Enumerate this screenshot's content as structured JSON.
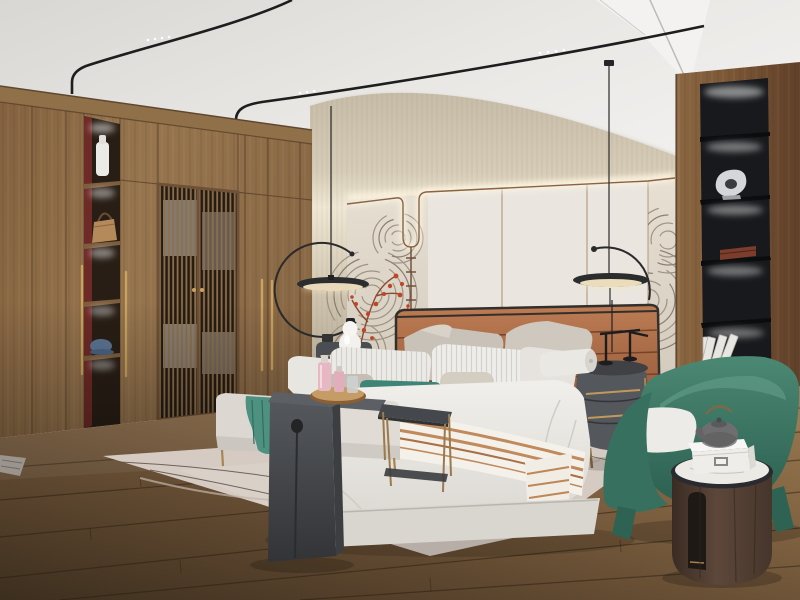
{
  "scene": {
    "type": "3d-interior-render",
    "room": "modern new-chinese style bedroom",
    "description": "Photorealistic render of a bedroom: walnut wardrobe with lit niches and lattice doors on the left, backlit mural feature wall and upholstered bed in the center, black display shelving in a wood wall on the right, green barrel armchair with drum side table, pale rug with pinecones on walnut plank flooring, disc pendant lamps and black ceiling light tracks",
    "lighting": "warm cove LED strips, niche spots and disc pendants",
    "camera": "three-quarter room view"
  },
  "palette": {
    "ceiling": "#e9e7e4",
    "cove_wall_beige": "#d8cdb8",
    "mural_cream": "#ded6c7",
    "panel_white": "#eae6df",
    "trim_walnut": "#8a6343",
    "wardrobe_wood": "#8f6f4a",
    "right_wall_wood": "#7a5636",
    "niche_black": "#17191c",
    "floor_wood": "#6b5236",
    "rug": "#d5cbc3",
    "headboard_leather": "#a8643f",
    "bedding_white": "#edebe7",
    "accent_teal": "#3f8577",
    "throw_teal": "#4f9180",
    "chair_green": "#3f7e6b",
    "furniture_grey": "#4a4d51",
    "brass": "#c9a35f",
    "red_coral": "#bf4527",
    "marble_top": "#eceae5"
  },
  "objects": {
    "ceiling": "white ceiling with curved black track lights",
    "cove_wall": "beige grasscloth cove wall with LED glow",
    "mural_wall": "feature wall with swirling ink-fan mural and backlit white panels",
    "wardrobe": "floor-to-ceiling walnut wardrobe with lit display niches, brass pulls and lattice doors",
    "display_niche": "lit wardrobe niches holding a vase, a handbag and a cap",
    "lattice_doors": "chinese lattice wardrobe doors with clothes behind",
    "right_wall": "walnut plank wall with recessed black shelving",
    "shelf_column": "black backlit shelves with silver sculpture, wooden box and leaning books",
    "bed": "upholstered king bed with caramel leather panel headboard",
    "pillows": "layered white, grey and striped pillows with teal lumbar cushion",
    "throw": "white throw with caramel stripes across the bed",
    "bench": "upholstered bench with folded teal throw",
    "waterfall_table": "dark grey waterfall table holding a wooden drinks tray",
    "tray": "round wooden tray with pink perfume bottles and glasses",
    "side_table": "dark metal side table with brass legs",
    "nightstand_left": "grey nightstand with white gourd lamp",
    "nightstand_right": "rounded grey nightstand with brass handles and black decor piece",
    "pendant_left": "black disc pendant with circular arm",
    "pendant_right": "black disc pendant with curved arm",
    "armchair": "green fabric barrel armchair with white seat cushion",
    "cylinder_table": "dark wood drum table with marble top, grey teapot and white box",
    "rug": "pale rug with thin branch-line motif and two pinecones",
    "floor": "walnut plank flooring",
    "red_branch": "red coral-like branch decor",
    "pinecones": "two pinecones on the rug"
  }
}
